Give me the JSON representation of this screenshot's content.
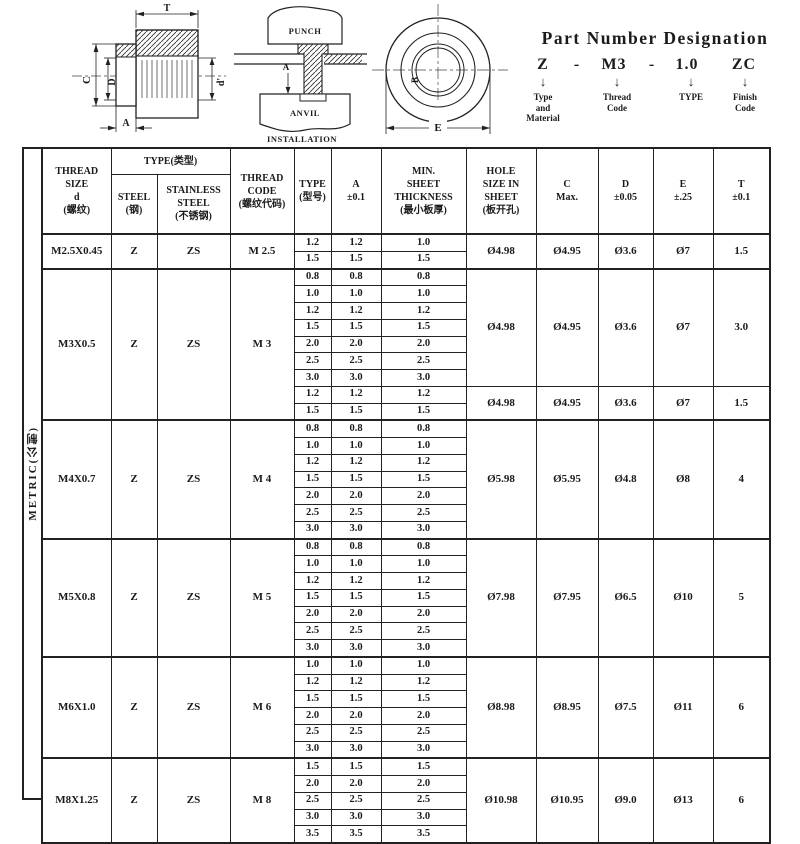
{
  "part_number": {
    "title": "Part Number Designation",
    "code": [
      "Z",
      "-",
      "M3",
      "-",
      "1.0",
      "ZC"
    ],
    "arrow": "↓",
    "labels": [
      "Type\nand\nMaterial",
      "Thread\nCode",
      "TYPE",
      "Finish\nCode"
    ]
  },
  "drawings": {
    "section_view": {
      "t": "T",
      "c": "C",
      "d": "D",
      "d_prime": "d'",
      "a": "A"
    },
    "installation": {
      "punch": "PUNCH",
      "anvil": "ANVIL",
      "a": "A",
      "caption": "INSTALLATION"
    },
    "front_view": {
      "b": "B",
      "e": "E"
    }
  },
  "table": {
    "side_label": "METRIC(公制)",
    "header": {
      "thread_size": "THREAD\nSIZE\nd\n(螺纹)",
      "type_group": "TYPE(类型)",
      "steel": "STEEL\n(钢)",
      "stainless": "STAINLESS\nSTEEL\n(不锈钢)",
      "thread_code": "THREAD\nCODE\n(螺纹代码)",
      "type_col": "TYPE\n(型号)",
      "a_col": "A\n±0.1",
      "min_sheet": "MIN.\nSHEET\nTHICKNESS\n(最小板厚)",
      "hole": "HOLE\nSIZE IN\nSHEET\n(板开孔)",
      "c_col": "C\nMax.",
      "d_col": "D\n±0.05",
      "e_col": "E\n±.25",
      "t_col": "T\n±0.1"
    },
    "groups": [
      {
        "thread_size": "M2.5X0.45",
        "steel": "Z",
        "stainless": "ZS",
        "thread_code": "M 2.5",
        "blocks": [
          {
            "rows": [
              [
                "1.2",
                "1.2",
                "1.0"
              ],
              [
                "1.5",
                "1.5",
                "1.5"
              ]
            ],
            "hole": "Ø4.98",
            "c": "Ø4.95",
            "d": "Ø3.6",
            "e": "Ø7",
            "t": "1.5"
          }
        ]
      },
      {
        "thread_size": "M3X0.5",
        "steel": "Z",
        "stainless": "ZS",
        "thread_code": "M 3",
        "blocks": [
          {
            "rows": [
              [
                "0.8",
                "0.8",
                "0.8"
              ],
              [
                "1.0",
                "1.0",
                "1.0"
              ],
              [
                "1.2",
                "1.2",
                "1.2"
              ],
              [
                "1.5",
                "1.5",
                "1.5"
              ],
              [
                "2.0",
                "2.0",
                "2.0"
              ],
              [
                "2.5",
                "2.5",
                "2.5"
              ],
              [
                "3.0",
                "3.0",
                "3.0"
              ]
            ],
            "hole": "Ø4.98",
            "c": "Ø4.95",
            "d": "Ø3.6",
            "e": "Ø7",
            "t": "3.0"
          },
          {
            "rows": [
              [
                "1.2",
                "1.2",
                "1.2"
              ],
              [
                "1.5",
                "1.5",
                "1.5"
              ]
            ],
            "hole": "Ø4.98",
            "c": "Ø4.95",
            "d": "Ø3.6",
            "e": "Ø7",
            "t": "1.5"
          }
        ]
      },
      {
        "thread_size": "M4X0.7",
        "steel": "Z",
        "stainless": "ZS",
        "thread_code": "M 4",
        "blocks": [
          {
            "rows": [
              [
                "0.8",
                "0.8",
                "0.8"
              ],
              [
                "1.0",
                "1.0",
                "1.0"
              ],
              [
                "1.2",
                "1.2",
                "1.2"
              ],
              [
                "1.5",
                "1.5",
                "1.5"
              ],
              [
                "2.0",
                "2.0",
                "2.0"
              ],
              [
                "2.5",
                "2.5",
                "2.5"
              ],
              [
                "3.0",
                "3.0",
                "3.0"
              ]
            ],
            "hole": "Ø5.98",
            "c": "Ø5.95",
            "d": "Ø4.8",
            "e": "Ø8",
            "t": "4"
          }
        ]
      },
      {
        "thread_size": "M5X0.8",
        "steel": "Z",
        "stainless": "ZS",
        "thread_code": "M 5",
        "blocks": [
          {
            "rows": [
              [
                "0.8",
                "0.8",
                "0.8"
              ],
              [
                "1.0",
                "1.0",
                "1.0"
              ],
              [
                "1.2",
                "1.2",
                "1.2"
              ],
              [
                "1.5",
                "1.5",
                "1.5"
              ],
              [
                "2.0",
                "2.0",
                "2.0"
              ],
              [
                "2.5",
                "2.5",
                "2.5"
              ],
              [
                "3.0",
                "3.0",
                "3.0"
              ]
            ],
            "hole": "Ø7.98",
            "c": "Ø7.95",
            "d": "Ø6.5",
            "e": "Ø10",
            "t": "5"
          }
        ]
      },
      {
        "thread_size": "M6X1.0",
        "steel": "Z",
        "stainless": "ZS",
        "thread_code": "M 6",
        "blocks": [
          {
            "rows": [
              [
                "1.0",
                "1.0",
                "1.0"
              ],
              [
                "1.2",
                "1.2",
                "1.2"
              ],
              [
                "1.5",
                "1.5",
                "1.5"
              ],
              [
                "2.0",
                "2.0",
                "2.0"
              ],
              [
                "2.5",
                "2.5",
                "2.5"
              ],
              [
                "3.0",
                "3.0",
                "3.0"
              ]
            ],
            "hole": "Ø8.98",
            "c": "Ø8.95",
            "d": "Ø7.5",
            "e": "Ø11",
            "t": "6"
          }
        ]
      },
      {
        "thread_size": "M8X1.25",
        "steel": "Z",
        "stainless": "ZS",
        "thread_code": "M 8",
        "blocks": [
          {
            "rows": [
              [
                "1.5",
                "1.5",
                "1.5"
              ],
              [
                "2.0",
                "2.0",
                "2.0"
              ],
              [
                "2.5",
                "2.5",
                "2.5"
              ],
              [
                "3.0",
                "3.0",
                "3.0"
              ],
              [
                "3.5",
                "3.5",
                "3.5"
              ]
            ],
            "hole": "Ø10.98",
            "c": "Ø10.95",
            "d": "Ø9.0",
            "e": "Ø13",
            "t": "6"
          }
        ]
      }
    ]
  }
}
